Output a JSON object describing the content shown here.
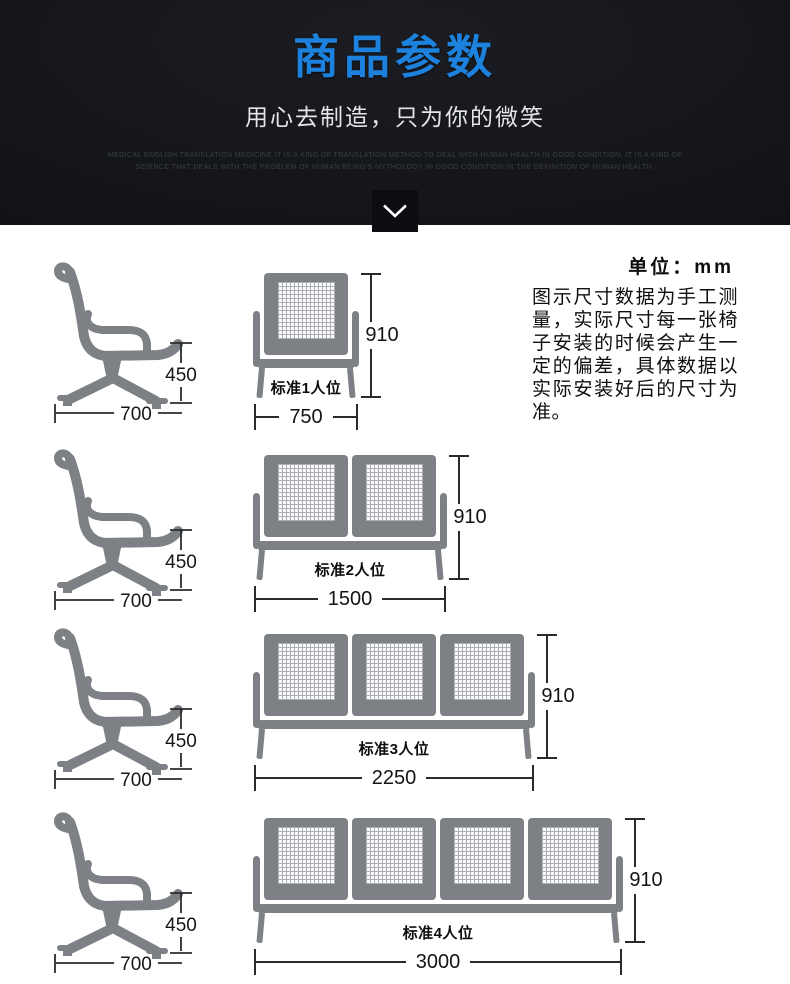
{
  "header": {
    "title": "商品参数",
    "subtitle": "用心去制造，只为你的微笑",
    "fine_print": [
      "MEDICAL ENGLISH TRANSLATION MEDICINE IT IS A KIND OF TRANSLATION METHOD TO DEAL WITH HUMAN HEALTH IN GOOD CONDITION. IT IS A KIND OF",
      "SCIENCE THAT DEALS WITH THE PROBLEM OF HUMAN BEING'S MYTHOLOGY IN GOOD CONDITION IN THE DEFINITION OF HUMAN HEALTH."
    ],
    "chevron_icon": "chevron-down"
  },
  "info": {
    "unit_label": "单位：mm",
    "note": "图示尺寸数据为手工测量，实际尺寸每一张椅子安装的时候会产生一定的偏差，具体数据以实际安装好后的尺寸为准。"
  },
  "side_chair": {
    "seat_height_mm": "450",
    "depth_mm": "700"
  },
  "benches": [
    {
      "seats": 1,
      "label": "标准1人位",
      "width_mm": "750",
      "height_mm": "910"
    },
    {
      "seats": 2,
      "label": "标准2人位",
      "width_mm": "1500",
      "height_mm": "910"
    },
    {
      "seats": 3,
      "label": "标准3人位",
      "width_mm": "2250",
      "height_mm": "910"
    },
    {
      "seats": 4,
      "label": "标准4人位",
      "width_mm": "3000",
      "height_mm": "910"
    }
  ],
  "colors": {
    "title_blue": "#1d82dd",
    "chair_gray": "#7d8186",
    "dim_line": "#2b2b2b",
    "banner_bg": "#121318"
  }
}
